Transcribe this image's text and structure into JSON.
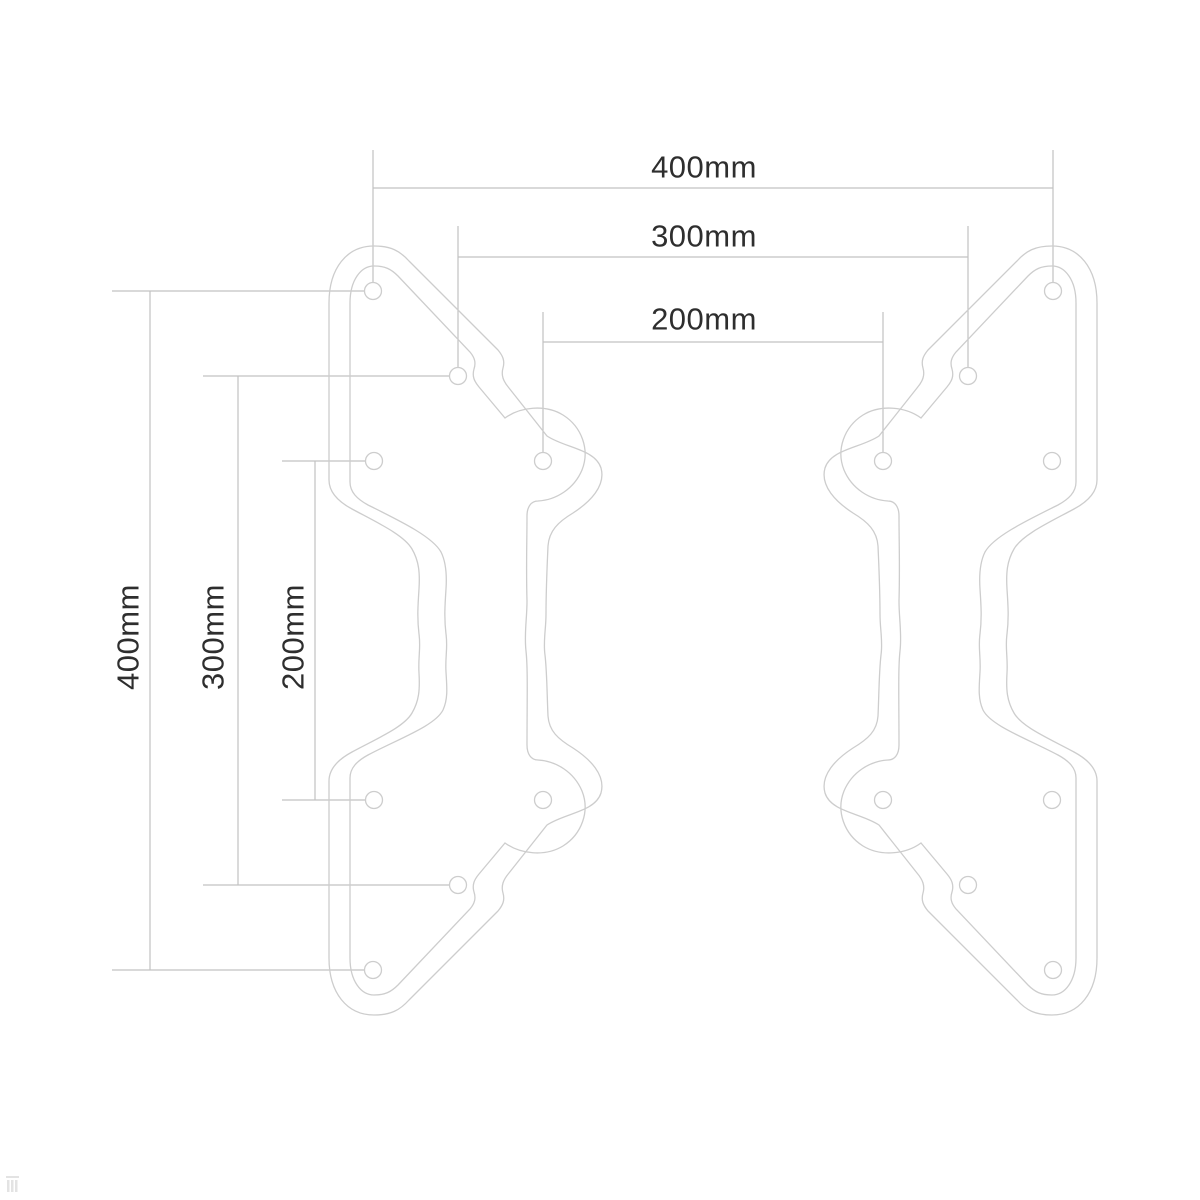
{
  "diagram": {
    "type": "technical-dimension-drawing",
    "subject": "Pair of mirrored VESA adapter bracket plates with mounting holes",
    "background_color": "#ffffff",
    "outline_color": "#cdcdcd",
    "dimension_line_color": "#c2c2c2",
    "text_color": "#2e2e2e",
    "horizontal_dimensions": [
      {
        "label": "400mm",
        "value_mm": 400
      },
      {
        "label": "300mm",
        "value_mm": 300
      },
      {
        "label": "200mm",
        "value_mm": 200
      }
    ],
    "vertical_dimensions": [
      {
        "label": "400mm",
        "value_mm": 400
      },
      {
        "label": "300mm",
        "value_mm": 300
      },
      {
        "label": "200mm",
        "value_mm": 200
      }
    ],
    "plates": {
      "count": 2,
      "mirrored": true,
      "holes_per_plate": 8,
      "hole_patterns_mm": [
        400,
        300,
        200
      ]
    }
  }
}
